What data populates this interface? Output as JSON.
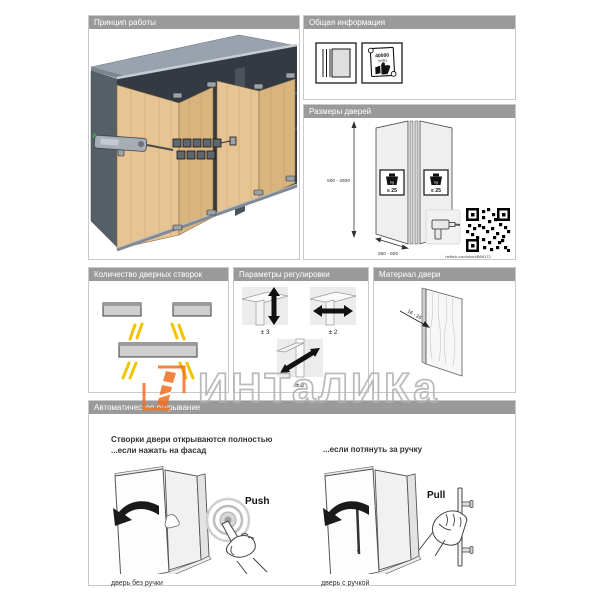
{
  "colors": {
    "accent_orange": "#f26e21",
    "highlight_yellow": "#f2c400",
    "wood": "#e4c291",
    "header_gray": "#9a9a9a"
  },
  "watermark": {
    "text": "ИНТаЛИКа"
  },
  "panels": {
    "principle": {
      "title": "Принцип работы"
    },
    "general_info": {
      "title": "Общая информация",
      "certificate_value": "40000",
      "certificate_unit": "cycles"
    },
    "door_sizes": {
      "title": "Размеры дверей",
      "height_range": "500 - 2600",
      "width_range": "250 - 600",
      "weight_limit": "≤ 25",
      "weight_unit": "kg",
      "link": "hettich.com/short/B68172"
    },
    "leaf_count": {
      "title": "Количество дверных створок"
    },
    "adjustment": {
      "title": "Параметры регулировки",
      "vertical_range": "± 3",
      "horizontal_range": "± 2",
      "depth_range": "± 2"
    },
    "door_material": {
      "title": "Материал двери",
      "thickness_range": "16 - 25"
    },
    "auto_opening": {
      "title": "Автоматическое открывание",
      "heading_line1": "Створки двери открываются полностью",
      "heading_line2": "...если нажать на фасад",
      "heading_right": "...если потянуть за ручку",
      "push_label": "Push",
      "pull_label": "Pull",
      "caption_left": "дверь без ручки",
      "caption_right": "дверь с ручкой"
    }
  }
}
